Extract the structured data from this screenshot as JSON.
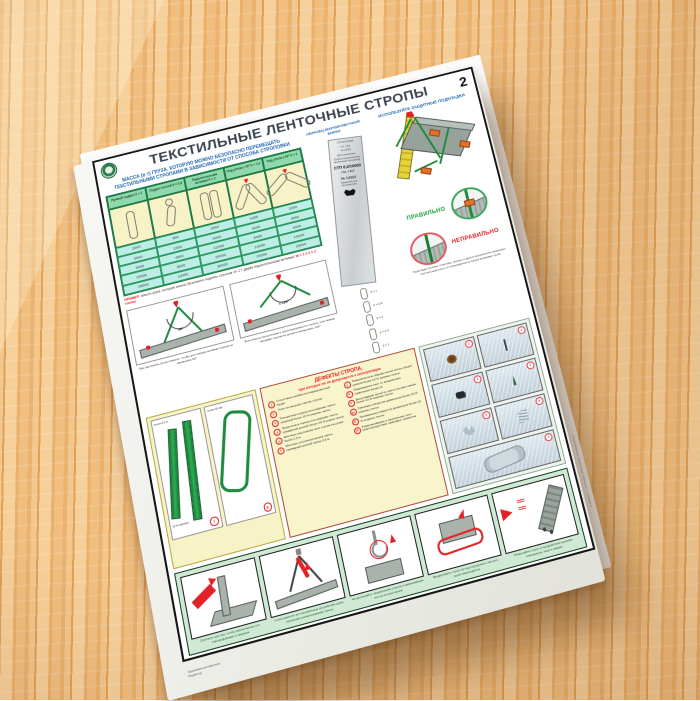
{
  "colors": {
    "accent_green": "#1d8a3c",
    "accent_red": "#e02227",
    "accent_blue": "#1f66b0",
    "table_header_green": "#8fd9ac",
    "table_cell_cyan": "#bdeee6",
    "panel_cream": "#f7f3c6",
    "band_green": "#cfe9d4"
  },
  "header": {
    "title": "ТЕКСТИЛЬНЫЕ ЛЕНТОЧНЫЕ СТРОПЫ",
    "number": "2"
  },
  "capacity": {
    "heading": "МАССА (в т) ГРУЗА, КОТОРУЮ МОЖНО БЕЗОПАСНО ПЕРЕМЕЩАТЬ ТЕКСТИЛЬНЫМИ СТРОПАМИ В ЗАВИСИМОСТИ ОТ СПОСОБА СТРОПОВКИ",
    "columns": [
      "Прямой подвес К = 1",
      "Подвес петлей К = 0,8",
      "Параллельными ветвями К = 2",
      "Под углом ≤ 45° К = 1,4",
      "Под углом ≤ 60° К = 1"
    ],
    "rows": [
      {
        "c1": "1000",
        "c2": "800",
        "c3": "2000",
        "c4": "1400",
        "c5": "1000"
      },
      {
        "c1": "3000",
        "c2": "2400",
        "c3": "6000",
        "c4": "4200",
        "c5": "3000"
      },
      {
        "c1": "6000",
        "c2": "4800",
        "c3": "12000",
        "c4": "8400",
        "c5": "6000"
      },
      {
        "c1": "10000",
        "c2": "8000",
        "c3": "20000",
        "c4": "14000",
        "c5": "10000"
      },
      {
        "c1": "18000",
        "c2": "14400",
        "c3": "36000",
        "c4": "25200",
        "c5": "18000"
      }
    ],
    "example_label": "ПРИМЕР:",
    "example_text": "масса груза, которую можно безопасно поднять стропом г/п 1 т двумя параллельными ветвями:",
    "example_formula": "М = 1 х 2 = 2 тонны"
  },
  "tag": {
    "heading": "ОБРАЗЕЦ МАРКИРОВОЧНОЙ БИРКИ",
    "lines": [
      "СТП 8,0/10000",
      "г/п, т 8,0",
      "№ 14323",
      "Дата испытания",
      "(Строп текстильный ленточный петлевой)",
      "СТП 8,0/10000",
      "г/п, т 8,0",
      "№ 14323",
      "Товарный знак изготовителя"
    ],
    "k_factors": [
      "К = 1",
      "К = 0,8",
      "К = 2",
      "К = 1,4",
      "К = 1"
    ]
  },
  "pads": {
    "heading": "ИСПОЛЬЗУЙТЕ ЗАЩИТНЫЕ ПОДКЛАДКИ",
    "correct": "ПРАВИЛЬНО",
    "incorrect": "НЕПРАВИЛЬНО",
    "caption": "Подкладки из кожи, пластика, резины и других материалов защищают текстильный строп от повреждения острыми кромками груза"
  },
  "angles": {
    "left_angle": "90°",
    "right_angle": "≤ 120°",
    "left_caption": "При застропке груза следите, чтобы угол между ветвями стропа не превышал 90°",
    "right_caption": "Если масса груза близка к грузоподъемности стропа, угол между ветвями стропа не должен превышать 120°"
  },
  "webbing": {
    "badge_left": "7",
    "badge_right": "8",
    "dim_a": "более 0,5 м",
    "dim_b": "более 50 мм",
    "dim_c": "10 % ширины"
  },
  "defects": {
    "heading_line1": "ДЕФЕКТЫ СТРОПА,",
    "heading_line2": "при которых он не допускается к эксплуатации",
    "left": [
      {
        "n": "1",
        "t": "Отсутствие клейма или маркировочной бирки"
      },
      {
        "n": "2",
        "t": "Узлы на несущих лентах стропа"
      },
      {
        "n": "3",
        "t": "Поперечные порезы или разрывы ленты шириной более 10 % ширины ленты"
      },
      {
        "n": "4",
        "t": "Продольные порезы или разрывы ленты суммарной длиной более 10 % длины ленты"
      },
      {
        "n": "5",
        "t": "Местные расслоения лент стропа на длине более 0,5 м"
      },
      {
        "n": "6",
        "t": "Местные отслоения кромок ленты суммарной длиной более 0,5 м"
      }
    ],
    "right": [
      {
        "n": "7",
        "t": "Поверхностные обрывы нитей ленты общей длиной более 10 % ширины ленты"
      },
      {
        "n": "8",
        "t": "Повреждения лент от воздействия химических веществ"
      },
      {
        "n": "9",
        "t": "Выпучивание нитей из ленты на расстояние более 10 % ширины ленты"
      },
      {
        "n": "10",
        "t": "Сквозные отверстия диаметром более 10 % ширины ленты"
      },
      {
        "n": "11",
        "t": "Прожженные отверстия диаметром более 10 % ширины ленты"
      },
      {
        "n": "12",
        "t": "Размочаливание и загрязнение лент нефтепродуктами, красками, цементом"
      }
    ]
  },
  "photos": {
    "items": [
      {
        "n": "1"
      },
      {
        "n": "2"
      },
      {
        "n": "3"
      },
      {
        "n": "4"
      },
      {
        "n": "5"
      },
      {
        "n": "6"
      },
      {
        "n": "7"
      }
    ]
  },
  "bottom": {
    "captions": [
      "Стропьте груз так, чтобы исключалось его опрокидывание и падение",
      "Строп крепите за специальные устройства груза, исключая соскальзывание ленты",
      "Не допускайте защемления стропа и навешивания его на острие крюка",
      "Выдергивать строп из-под опущенного на него груза запрещается",
      "Оберегайте строп от воздействия высоких температур, искр и сварки"
    ]
  },
  "credits": {
    "line1": "Художник-составитель",
    "line2": "Редактор"
  },
  "publisher": "«Текстильные ленточные стропы» — плакат 2"
}
